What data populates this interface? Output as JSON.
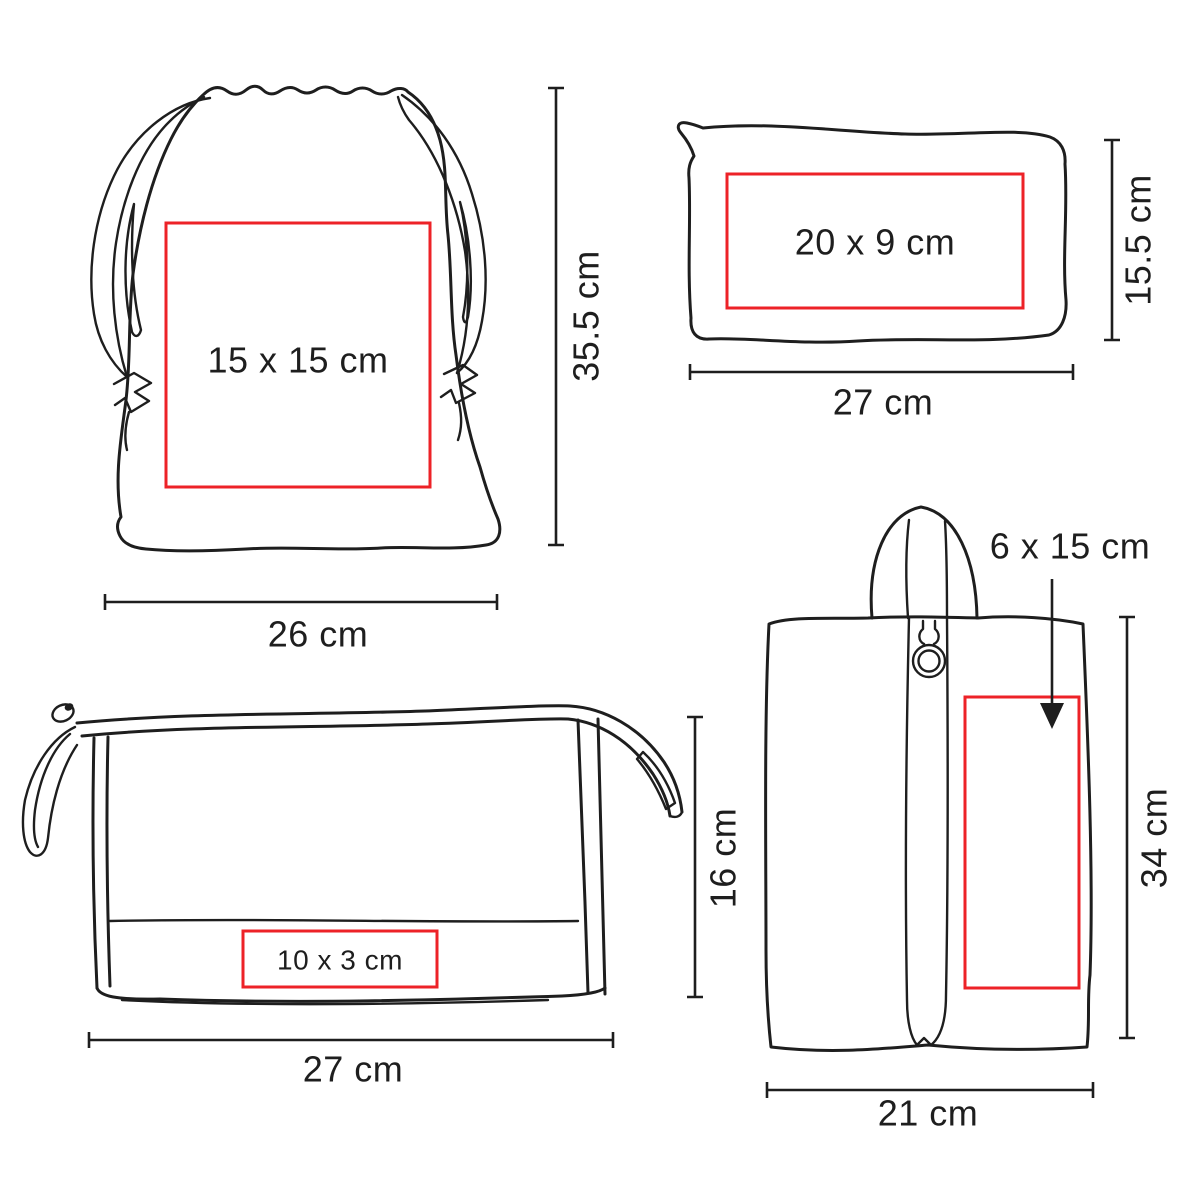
{
  "canvas": {
    "background": "#ffffff",
    "line_color": "#1e1e1e",
    "print_area_color": "#ed2227"
  },
  "bags": [
    {
      "name": "drawstring-bag",
      "print_area": "15 x 15 cm",
      "height": "35.5 cm",
      "width": "26 cm"
    },
    {
      "name": "zippered-pouch",
      "print_area": "20 x 9 cm",
      "height": "15.5 cm",
      "width": "27 cm"
    },
    {
      "name": "cosmetic-bag",
      "print_area": "10 x 3 cm",
      "height": "16 cm",
      "width": "27 cm"
    },
    {
      "name": "shoe-bag",
      "print_area": "6 x 15 cm",
      "height": "34 cm",
      "width": "21 cm"
    }
  ]
}
